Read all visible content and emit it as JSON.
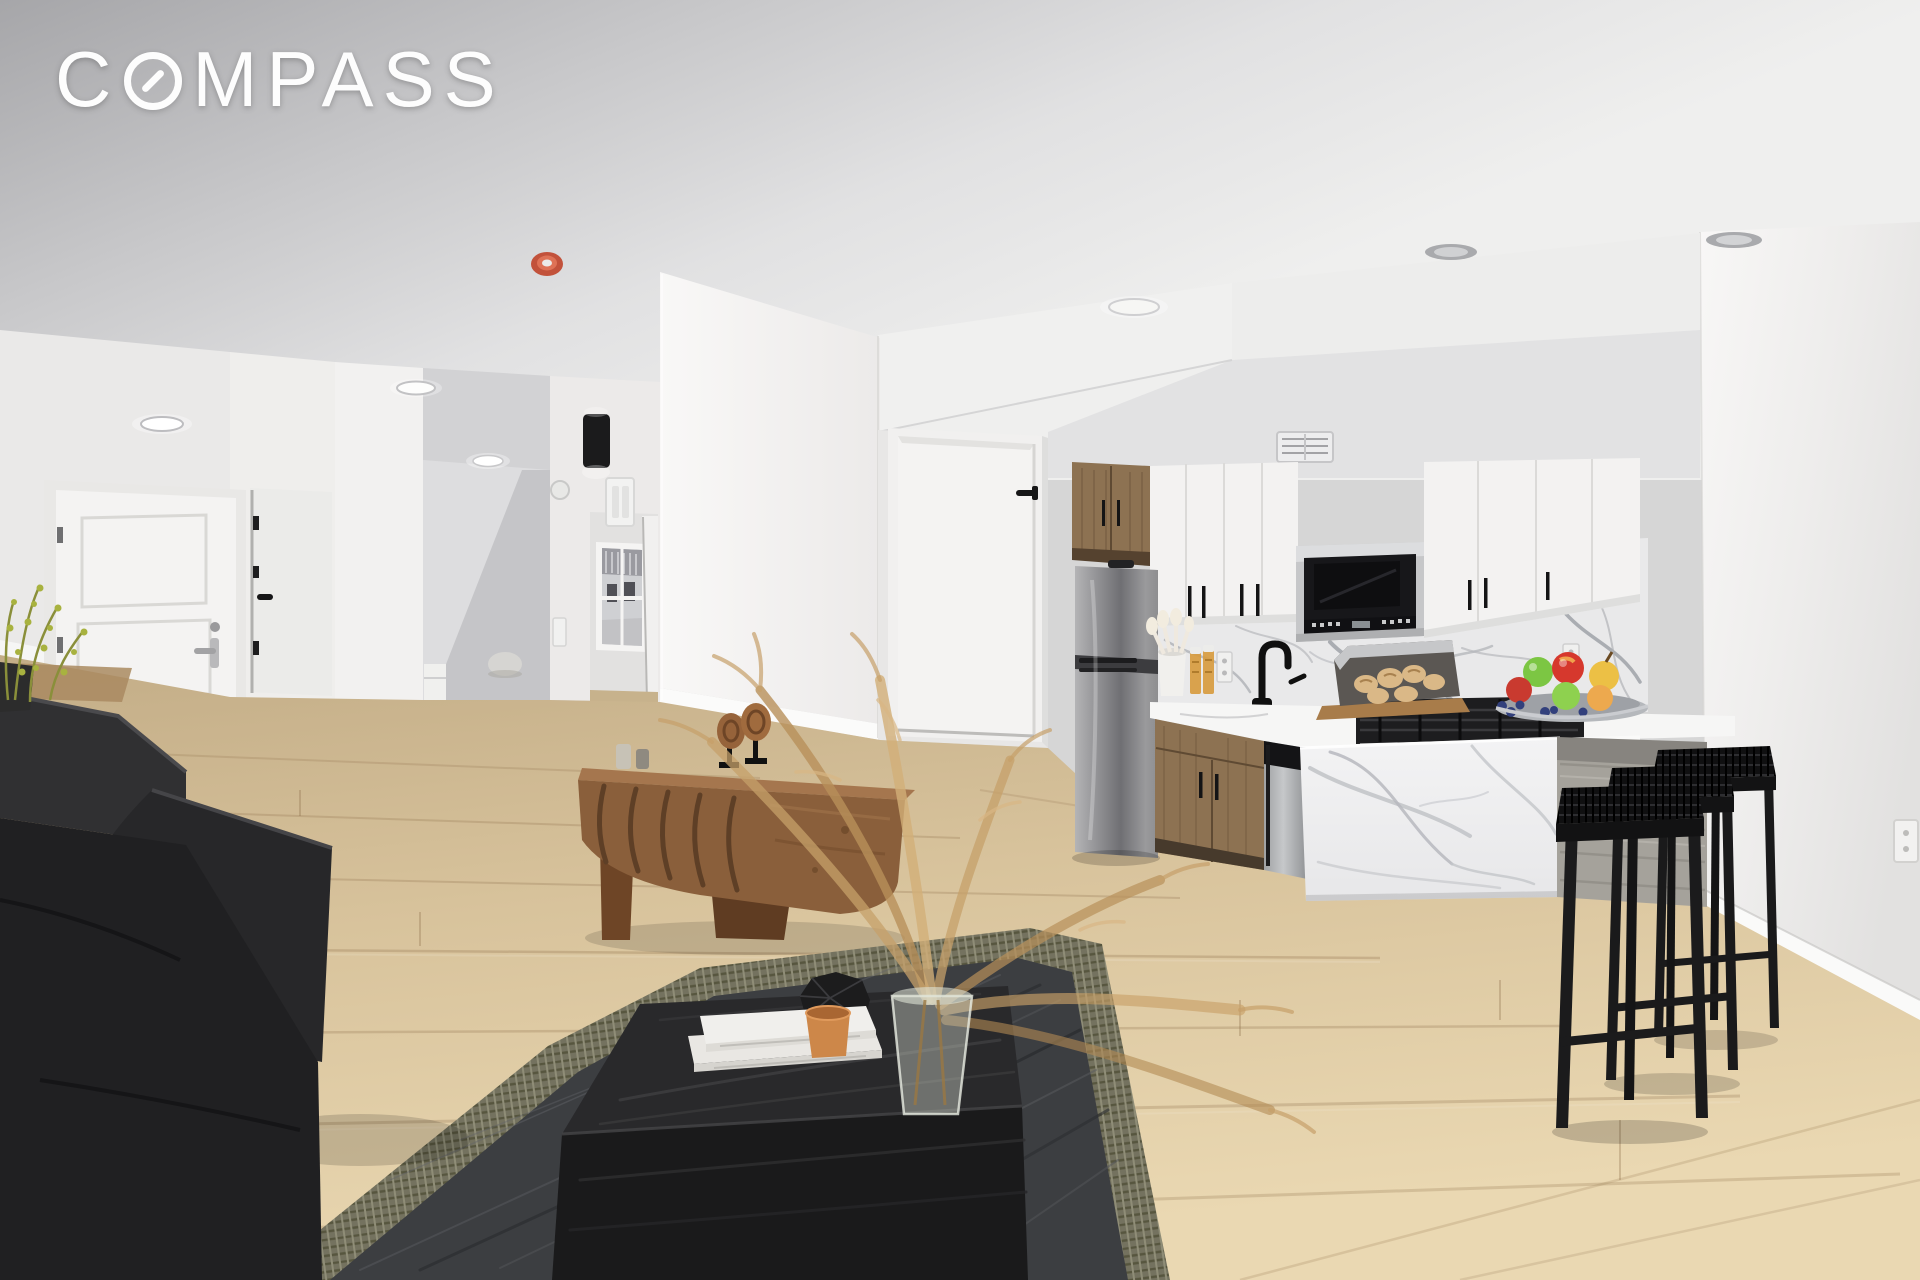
{
  "watermark": {
    "brand_c": "C",
    "brand_rest": "MPASS",
    "full": "COMPASS"
  },
  "scene": {
    "kind": "real-estate listing photograph",
    "room": "open-plan living room with galley kitchen, breakfast peninsula and entry hall",
    "staging": [
      "black sofa",
      "charcoal area rug",
      "black wood coffee table",
      "stacked white books",
      "orange cup",
      "black faceted vase",
      "glass vase with dried pampas grass",
      "walnut console with wood sculpture",
      "three black woven bar stools",
      "fruit bowl",
      "bread board"
    ]
  },
  "palette": {
    "logo": "#fdfdfd",
    "ceiling_a": "#a6a6a9",
    "ceiling_b": "#efefee",
    "wall": "#f1f0ef",
    "wall_bright": "#f8f7f6",
    "wall_shade": "#e7e6e5",
    "hall": "#d8d8da",
    "stair": "#c5c5c8",
    "door": "#f4f3f2",
    "trim": "#efeeec",
    "silver": "#9c9c9e",
    "black": "#161617",
    "floor_a": "#c3ad87",
    "floor_b": "#d8c39c",
    "floor_c": "#ead8b2",
    "plank": "#8b6c48",
    "wood_cab": "#8d7252",
    "wood_dark": "#5f4a33",
    "cab_white": "#f3f2f1",
    "steel": "#c6c7c9",
    "mw_black": "#17171a",
    "splash": "#e9e9ea",
    "vein": "#b3b5ba",
    "counter": "#f6f6f5",
    "island": "#f3f3f4",
    "panel_wood": "#a5a29b",
    "rug_border": "#74725f",
    "rug_field": "#3c3e41",
    "table": "#29292b",
    "table_front": "#1a1a1b",
    "book": "#f0efec",
    "cup": "#cd8749",
    "vase_black": "#1c1c1d",
    "pampas": "#c6a06a",
    "console": "#8a5f3b",
    "console_dark": "#6e4526",
    "sofa": "#2c2c2e",
    "sofa_dark": "#202022",
    "plant": "#a8b23f",
    "fruit_red": "#d6382d",
    "fruit_green": "#7cc643",
    "fruit_yellow": "#ecc045",
    "berry": "#32407c",
    "bread": "#dab887",
    "detector": "#c2523b",
    "glass": "#cfd4c8"
  }
}
